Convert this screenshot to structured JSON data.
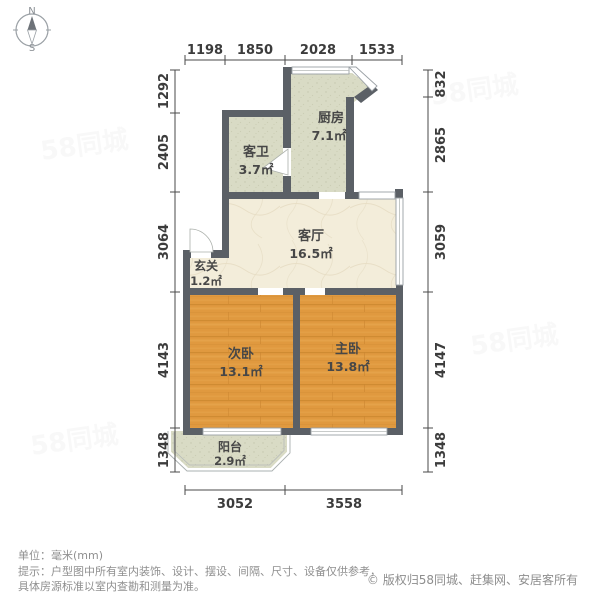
{
  "compass": {
    "north": "N",
    "south": "S"
  },
  "plan": {
    "rooms": {
      "kitchen": {
        "name": "厨房",
        "area": "7.1㎡"
      },
      "bath": {
        "name": "客卫",
        "area": "3.7㎡"
      },
      "living": {
        "name": "客厅",
        "area": "16.5㎡"
      },
      "entry": {
        "name": "玄关",
        "area": "1.2㎡"
      },
      "bedroom2": {
        "name": "次卧",
        "area": "13.1㎡"
      },
      "bedroom1": {
        "name": "主卧",
        "area": "13.8㎡"
      },
      "balcony": {
        "name": "阳台",
        "area": "2.9㎡"
      }
    },
    "dimensions": {
      "top": [
        "1198",
        "1850",
        "2028",
        "1533"
      ],
      "left": [
        "1292",
        "2405",
        "3064",
        "4143",
        "1348"
      ],
      "right": [
        "832",
        "2865",
        "3059",
        "4147",
        "1348"
      ],
      "bottom": [
        "3052",
        "3558"
      ]
    }
  },
  "watermark": "58同城",
  "footer": {
    "unit": "单位：毫米(mm)",
    "tip_line1": "提示：户型图中所有室内装饰、设计、摆设、间隔、尺寸、设备仅供参考，",
    "tip_line2": "具体房源标准以室内查勘和测量为准。",
    "copyright": "© 版权归58同城、赶集网、安居客所有"
  },
  "colors": {
    "wall": "#5b6066",
    "floor_wet": "#d9dbc5",
    "floor_living": "#f3edda",
    "floor_wood": "#e0993f",
    "dim_text": "#3c3c3c",
    "footer_text": "#8f8f8f"
  }
}
